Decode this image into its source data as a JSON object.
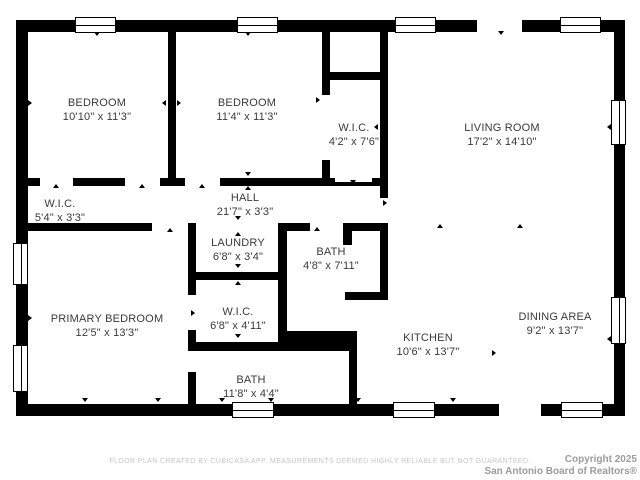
{
  "title": "Residential floor plan",
  "colors": {
    "bg": "#ffffff",
    "wall": "#000000",
    "text": "#3a3a3a",
    "disclaimer": "#c6c6c6",
    "copyright": "#9c9c9c"
  },
  "rooms": [
    {
      "id": "bedroom-1",
      "name": "BEDROOM",
      "dims": "10'10\" x 11'3\"",
      "cx": 97,
      "cy": 110
    },
    {
      "id": "bedroom-2",
      "name": "BEDROOM",
      "dims": "11'4\" x 11'3\"",
      "cx": 247,
      "cy": 110
    },
    {
      "id": "wic-top",
      "name": "W.I.C.",
      "dims": "4'2\" x 7'6\"",
      "cx": 354,
      "cy": 135
    },
    {
      "id": "living-room",
      "name": "LIVING ROOM",
      "dims": "17'2\" x 14'10\"",
      "cx": 502,
      "cy": 135
    },
    {
      "id": "wic-left",
      "name": "W.I.C.",
      "dims": "5'4\" x 3'3\"",
      "cx": 60,
      "cy": 211
    },
    {
      "id": "hall",
      "name": "HALL",
      "dims": "21'7\" x 3'3\"",
      "cx": 245,
      "cy": 205
    },
    {
      "id": "laundry",
      "name": "LAUNDRY",
      "dims": "6'8\" x 3'4\"",
      "cx": 238,
      "cy": 250
    },
    {
      "id": "bath-hall",
      "name": "BATH",
      "dims": "4'8\" x 7'11\"",
      "cx": 331,
      "cy": 259
    },
    {
      "id": "wic-primary",
      "name": "W.I.C.",
      "dims": "6'8\" x 4'11\"",
      "cx": 238,
      "cy": 319
    },
    {
      "id": "primary-bedroom",
      "name": "PRIMARY BEDROOM",
      "dims": "12'5\" x 13'3\"",
      "cx": 107,
      "cy": 326
    },
    {
      "id": "bath-primary",
      "name": "BATH",
      "dims": "11'8\" x 4'4\"",
      "cx": 251,
      "cy": 387
    },
    {
      "id": "kitchen",
      "name": "KITCHEN",
      "dims": "10'6\" x 13'7\"",
      "cx": 428,
      "cy": 345
    },
    {
      "id": "dining-area",
      "name": "DINING AREA",
      "dims": "9'2\" x 13'7\"",
      "cx": 555,
      "cy": 324
    }
  ],
  "plan": {
    "walls": [
      {
        "x": 16,
        "y": 20,
        "w": 609,
        "h": 12
      },
      {
        "x": 16,
        "y": 404,
        "w": 609,
        "h": 12
      },
      {
        "x": 16,
        "y": 20,
        "w": 12,
        "h": 396
      },
      {
        "x": 614,
        "y": 20,
        "w": 11,
        "h": 396
      },
      {
        "x": 168,
        "y": 32,
        "w": 8,
        "h": 146
      },
      {
        "x": 27,
        "y": 178,
        "w": 13,
        "h": 8
      },
      {
        "x": 73,
        "y": 178,
        "w": 52,
        "h": 8
      },
      {
        "x": 160,
        "y": 178,
        "w": 25,
        "h": 8
      },
      {
        "x": 220,
        "y": 178,
        "w": 102,
        "h": 8
      },
      {
        "x": 322,
        "y": 32,
        "w": 8,
        "h": 63
      },
      {
        "x": 322,
        "y": 160,
        "w": 8,
        "h": 18
      },
      {
        "x": 330,
        "y": 72,
        "w": 50,
        "h": 8
      },
      {
        "x": 380,
        "y": 32,
        "w": 8,
        "h": 146
      },
      {
        "x": 322,
        "y": 178,
        "w": 66,
        "h": 8
      },
      {
        "x": 380,
        "y": 186,
        "w": 8,
        "h": 12
      },
      {
        "x": 27,
        "y": 223,
        "w": 125,
        "h": 8
      },
      {
        "x": 188,
        "y": 223,
        "w": 8,
        "h": 72
      },
      {
        "x": 188,
        "y": 330,
        "w": 8,
        "h": 12
      },
      {
        "x": 196,
        "y": 272,
        "w": 89,
        "h": 8
      },
      {
        "x": 278,
        "y": 223,
        "w": 9,
        "h": 119
      },
      {
        "x": 278,
        "y": 223,
        "w": 32,
        "h": 8
      },
      {
        "x": 343,
        "y": 223,
        "w": 45,
        "h": 8
      },
      {
        "x": 343,
        "y": 231,
        "w": 9,
        "h": 14
      },
      {
        "x": 345,
        "y": 292,
        "w": 43,
        "h": 8
      },
      {
        "x": 380,
        "y": 223,
        "w": 8,
        "h": 77
      },
      {
        "x": 188,
        "y": 342,
        "w": 169,
        "h": 9
      },
      {
        "x": 280,
        "y": 331,
        "w": 77,
        "h": 11
      },
      {
        "x": 349,
        "y": 351,
        "w": 8,
        "h": 53
      },
      {
        "x": 188,
        "y": 372,
        "w": 8,
        "h": 32
      }
    ],
    "windows_h": [
      {
        "x": 75,
        "y": 17,
        "w": 41,
        "h": 16
      },
      {
        "x": 237,
        "y": 17,
        "w": 41,
        "h": 16
      },
      {
        "x": 395,
        "y": 17,
        "w": 41,
        "h": 16
      },
      {
        "x": 560,
        "y": 17,
        "w": 41,
        "h": 16
      },
      {
        "x": 232,
        "y": 402,
        "w": 42,
        "h": 16
      },
      {
        "x": 393,
        "y": 402,
        "w": 42,
        "h": 16
      },
      {
        "x": 561,
        "y": 402,
        "w": 42,
        "h": 16
      }
    ],
    "windows_v": [
      {
        "x": 13,
        "y": 243,
        "w": 15,
        "h": 42
      },
      {
        "x": 13,
        "y": 345,
        "w": 15,
        "h": 47
      },
      {
        "x": 611,
        "y": 100,
        "w": 15,
        "h": 45
      },
      {
        "x": 611,
        "y": 297,
        "w": 15,
        "h": 47
      }
    ],
    "openings": [
      {
        "x": 477,
        "y": 20,
        "w": 45,
        "h": 12
      },
      {
        "x": 499,
        "y": 404,
        "w": 42,
        "h": 12
      },
      {
        "x": 335,
        "y": 178,
        "w": 37,
        "h": 4
      }
    ],
    "ticks": [
      {
        "x": 94,
        "y": 32,
        "dir": "down"
      },
      {
        "x": 245,
        "y": 32,
        "dir": "down"
      },
      {
        "x": 498,
        "y": 31,
        "dir": "down"
      },
      {
        "x": 28,
        "y": 100,
        "dir": "right"
      },
      {
        "x": 162,
        "y": 100,
        "dir": "left"
      },
      {
        "x": 177,
        "y": 100,
        "dir": "right"
      },
      {
        "x": 316,
        "y": 97,
        "dir": "right"
      },
      {
        "x": 374,
        "y": 124,
        "dir": "left"
      },
      {
        "x": 607,
        "y": 124,
        "dir": "left"
      },
      {
        "x": 53,
        "y": 184,
        "dir": "up"
      },
      {
        "x": 139,
        "y": 184,
        "dir": "up"
      },
      {
        "x": 199,
        "y": 184,
        "dir": "up"
      },
      {
        "x": 245,
        "y": 172,
        "dir": "down"
      },
      {
        "x": 245,
        "y": 186,
        "dir": "up"
      },
      {
        "x": 350,
        "y": 180,
        "dir": "down"
      },
      {
        "x": 383,
        "y": 200,
        "dir": "right"
      },
      {
        "x": 167,
        "y": 228,
        "dir": "up"
      },
      {
        "x": 235,
        "y": 216,
        "dir": "down"
      },
      {
        "x": 235,
        "y": 232,
        "dir": "up"
      },
      {
        "x": 314,
        "y": 227,
        "dir": "up"
      },
      {
        "x": 437,
        "y": 224,
        "dir": "up"
      },
      {
        "x": 517,
        "y": 224,
        "dir": "up"
      },
      {
        "x": 235,
        "y": 264,
        "dir": "down"
      },
      {
        "x": 235,
        "y": 281,
        "dir": "up"
      },
      {
        "x": 28,
        "y": 315,
        "dir": "right"
      },
      {
        "x": 191,
        "y": 310,
        "dir": "right"
      },
      {
        "x": 607,
        "y": 336,
        "dir": "left"
      },
      {
        "x": 235,
        "y": 334,
        "dir": "down"
      },
      {
        "x": 492,
        "y": 350,
        "dir": "right"
      },
      {
        "x": 82,
        "y": 398,
        "dir": "down"
      },
      {
        "x": 155,
        "y": 398,
        "dir": "down"
      },
      {
        "x": 219,
        "y": 398,
        "dir": "down"
      },
      {
        "x": 268,
        "y": 398,
        "dir": "down"
      },
      {
        "x": 355,
        "y": 398,
        "dir": "down"
      },
      {
        "x": 450,
        "y": 398,
        "dir": "down"
      }
    ]
  },
  "footer": {
    "disclaimer": "FLOOR PLAN CREATED BY CUBICASA APP. MEASUREMENTS DEEMED HIGHLY RELIABLE BUT NOT GUARANTEED.",
    "copyright_line1": "Copyright 2025",
    "copyright_line2": "San Antonio Board of Realtors®"
  }
}
